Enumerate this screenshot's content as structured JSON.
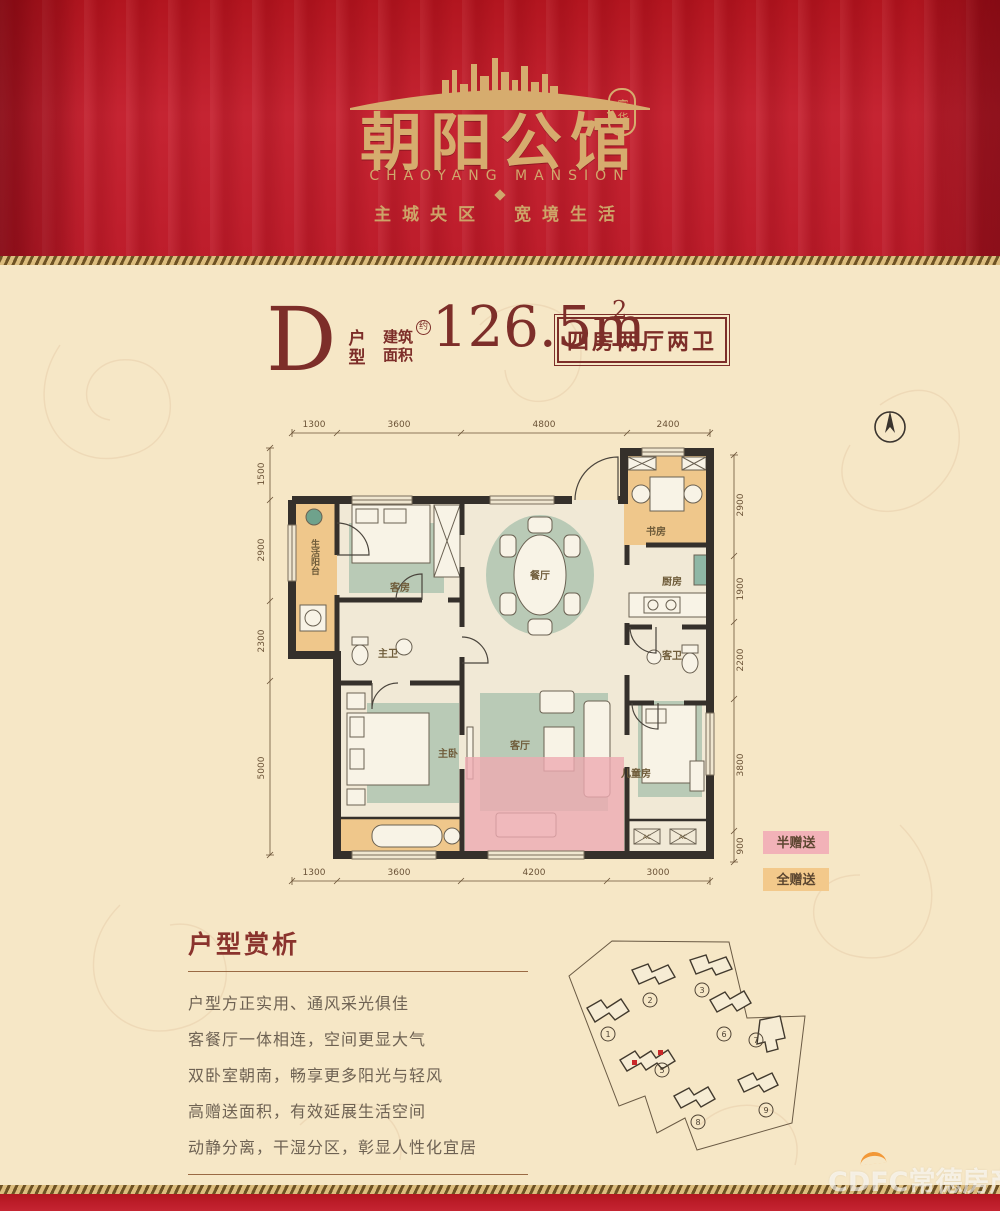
{
  "header": {
    "seal": "富华",
    "title": "朝阳公馆",
    "subtitle": "CHAOYANG MANSION",
    "slogan": "主城央区　宽境生活",
    "curtain_color": "#bd1d2b",
    "gold_color": "#d6ac6e"
  },
  "unit": {
    "letter": "D",
    "suffix_top": "户",
    "suffix_bottom": "型",
    "area_label_top": "建筑",
    "area_label_bottom": "面积",
    "area_note": "约",
    "area_value": "126.5m",
    "area_exp": "2",
    "badge": "四房两厅两卫",
    "accent_color": "#7d2e29"
  },
  "floorplan": {
    "dims_top": [
      "1300",
      "3600",
      "4800",
      "2400"
    ],
    "dims_bottom": [
      "1300",
      "3600",
      "4200",
      "3000"
    ],
    "dims_left": [
      "1500",
      "2900",
      "2300",
      "5000"
    ],
    "dims_right": [
      "2900",
      "1900",
      "2200",
      "3800",
      "900"
    ],
    "labels": {
      "balcony": "生活阳台",
      "guest": "客房",
      "dining": "餐厅",
      "study": "书房",
      "kitchen": "厨房",
      "master_bath": "主卫",
      "guest_bath": "客卫",
      "master": "主卧",
      "living": "客厅",
      "kids": "儿童房",
      "ac1": "AC",
      "ac2": "AC"
    },
    "legend": [
      {
        "label": "半赠送",
        "color": "#f2b2b8"
      },
      {
        "label": "全赠送",
        "color": "#f3c98b"
      }
    ],
    "wall_color": "#35302b",
    "highlight_pink": "#eeaab2",
    "highlight_orange": "#efc78b"
  },
  "analysis": {
    "title": "户型赏析",
    "lines": [
      "户型方正实用、通风采光俱佳",
      "客餐厅一体相连，空间更显大气",
      "双卧室朝南，畅享更多阳光与轻风",
      "高赠送面积，有效延展生活空间",
      "动静分离，干湿分区，彰显人性化宜居"
    ]
  },
  "siteplan": {
    "buildings": [
      "1",
      "2",
      "3",
      "5",
      "6",
      "7",
      "8",
      "9"
    ],
    "highlighted_building": "5",
    "highlight_dot_color": "#c9282a"
  },
  "watermark": {
    "brand": "CDFC",
    "name": "常德房产"
  }
}
